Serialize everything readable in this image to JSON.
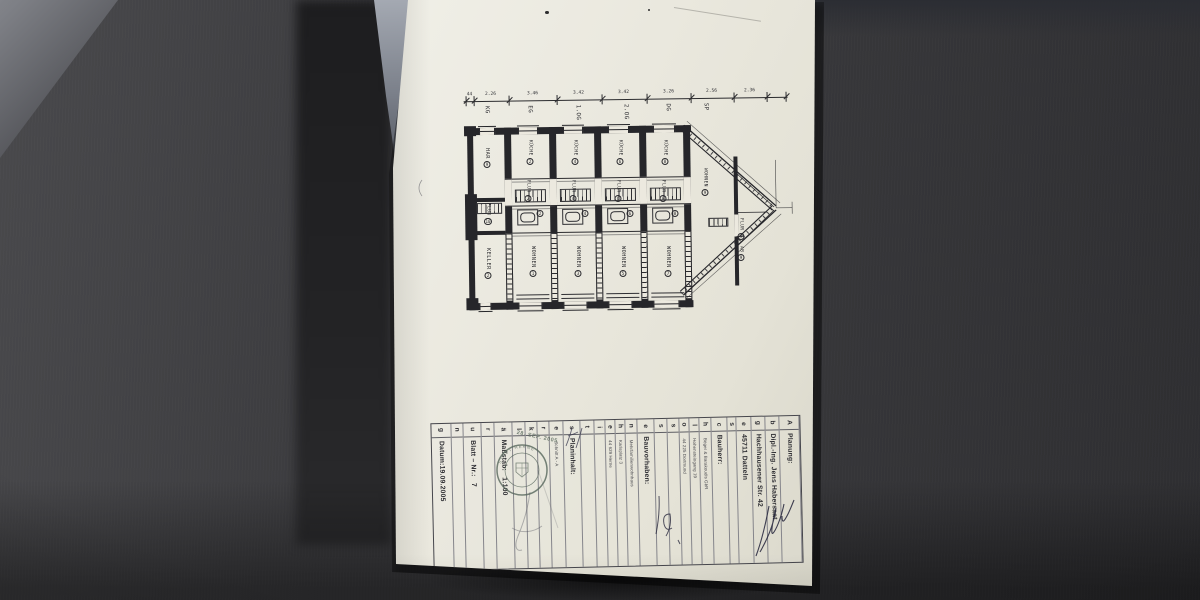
{
  "drawing": {
    "dimension": {
      "ticks": [
        {
          "css": "left:79px"
        },
        {
          "css": "left:87px"
        },
        {
          "css": "left:122px"
        },
        {
          "css": "left:170px"
        },
        {
          "css": "left:215px"
        },
        {
          "css": "left:260px"
        },
        {
          "css": "left:304px"
        },
        {
          "css": "left:347px"
        },
        {
          "css": "left:380px"
        },
        {
          "css": "left:399px"
        }
      ],
      "values": [
        {
          "v": "44",
          "css": "left:83px"
        },
        {
          "v": "2.26",
          "css": "left:104px"
        },
        {
          "v": "3.46",
          "css": "left:146px"
        },
        {
          "v": "3.42",
          "css": "left:192px"
        },
        {
          "v": "3.42",
          "css": "left:237px"
        },
        {
          "v": "3.26",
          "css": "left:282px"
        },
        {
          "v": "2.56",
          "css": "left:325px"
        },
        {
          "v": "2.36",
          "css": "left:363px"
        }
      ],
      "floors": [
        {
          "t": "KG",
          "css": "left:97px"
        },
        {
          "t": "EG",
          "css": "left:140px"
        },
        {
          "t": "1.OG",
          "css": "left:188px"
        },
        {
          "t": "2.OG",
          "css": "left:236px"
        },
        {
          "t": "DG",
          "css": "left:278px"
        },
        {
          "t": "SP",
          "css": "left:316px"
        }
      ]
    },
    "rooms": [
      {
        "t": "HAR",
        "n": "9",
        "cls": "rm",
        "css": "left:99px;top:148px"
      },
      {
        "t": "FLUR",
        "n": "10",
        "cls": "rm-sm",
        "css": "left:100px;top:203px"
      },
      {
        "t": "KELLER",
        "n": "2",
        "cls": "rm",
        "css": "left:100px;top:248px"
      },
      {
        "t": "KÜCHE",
        "n": "2",
        "cls": "rm-sm",
        "css": "left:142px;top:140px"
      },
      {
        "t": "FLUR",
        "n": "2",
        "cls": "rm-sm",
        "css": "left:140px;top:180px"
      },
      {
        "t": "",
        "n": "2",
        "cls": "circ",
        "css": "left:152px;top:210px"
      },
      {
        "t": "WOHNEN",
        "n": "1",
        "cls": "rm",
        "css": "left:145px;top:246px"
      },
      {
        "t": "KÜCHE",
        "n": "4",
        "cls": "rm-sm",
        "css": "left:187px;top:140px"
      },
      {
        "t": "FLUR",
        "n": "4",
        "cls": "rm-sm",
        "css": "left:185px;top:180px"
      },
      {
        "t": "",
        "n": "4",
        "cls": "circ",
        "css": "left:197px;top:210px"
      },
      {
        "t": "WOHNEN",
        "n": "3",
        "cls": "rm",
        "css": "left:190px;top:246px"
      },
      {
        "t": "KÜCHE",
        "n": "6",
        "cls": "rm-sm",
        "css": "left:232px;top:140px"
      },
      {
        "t": "FLUR",
        "n": "6",
        "cls": "rm-sm",
        "css": "left:230px;top:180px"
      },
      {
        "t": "",
        "n": "6",
        "cls": "circ",
        "css": "left:242px;top:210px"
      },
      {
        "t": "WOHNEN",
        "n": "5",
        "cls": "rm",
        "css": "left:235px;top:246px"
      },
      {
        "t": "KÜCHE",
        "n": "8",
        "cls": "rm-sm",
        "css": "left:277px;top:140px"
      },
      {
        "t": "FLUR",
        "n": "8",
        "cls": "rm-sm",
        "css": "left:275px;top:180px"
      },
      {
        "t": "",
        "n": "8",
        "cls": "circ",
        "css": "left:287px;top:210px"
      },
      {
        "t": "WOHNEN",
        "n": "7",
        "cls": "rm",
        "css": "left:280px;top:246px"
      },
      {
        "t": "WOHNEN",
        "n": "9",
        "cls": "rm-sm",
        "css": "left:317px;top:168px"
      },
      {
        "t": "FLUR",
        "n": "9",
        "cls": "rm-sm",
        "css": "left:353px;top:218px"
      },
      {
        "t": "AB",
        "n": "9",
        "cls": "rm-sm",
        "css": "left:353px;top:246px"
      }
    ]
  },
  "titleblock": {
    "vertical_word": "Abgeschlossenheitserklärung",
    "columns": [
      {
        "letter": "A",
        "text": "Planung:",
        "cls": "main strong",
        "css": "flex:18 0 0"
      },
      {
        "letter": "b",
        "text": "Dipl.-Ing. Jens Habersaat",
        "cls": "main",
        "css": "flex:13 0 0"
      },
      {
        "letter": "g",
        "text": "Hachhausener Str. 42",
        "cls": "main",
        "css": "flex:13 0 0"
      },
      {
        "letter": "e",
        "text": "45711 Datteln",
        "cls": "main",
        "css": "flex:13 0 0"
      },
      {
        "letter": "s",
        "text": "",
        "cls": "sm",
        "css": "flex:8 0 0"
      },
      {
        "letter": "c",
        "text": "Bauherr:",
        "cls": "main strong",
        "css": "flex:15 0 0"
      },
      {
        "letter": "h",
        "text": "Böger & Barakoudis GbR",
        "cls": "sm",
        "css": "flex:10 0 0"
      },
      {
        "letter": "l",
        "text": "Hohensteingang 19",
        "cls": "sm",
        "css": "flex:9 0 0"
      },
      {
        "letter": "o",
        "text": "44 225 Dortmund",
        "cls": "sm",
        "css": "flex:9 0 0"
      },
      {
        "letter": "s",
        "text": "",
        "cls": "sm",
        "css": "flex:10 0 0"
      },
      {
        "letter": "s",
        "text": "",
        "cls": "sm",
        "css": "flex:12 0 0"
      },
      {
        "letter": "e",
        "text": "Bauvorhaben:",
        "cls": "main strong",
        "css": "flex:16 0 0"
      },
      {
        "letter": "n",
        "text": "Mehrfamilienwohnhaus",
        "cls": "sm",
        "css": "flex:10 0 0"
      },
      {
        "letter": "h",
        "text": "Karlsplatz 3",
        "cls": "sm",
        "css": "flex:9 0 0"
      },
      {
        "letter": "e",
        "text": "44 629 Herne",
        "cls": "sm",
        "css": "flex:9 0 0"
      },
      {
        "letter": "i",
        "text": "",
        "cls": "sm",
        "css": "flex:10 0 0"
      },
      {
        "letter": "t",
        "text": "",
        "cls": "sm",
        "css": "flex:12 0 0"
      },
      {
        "letter": "s",
        "text": "Planinhalt:",
        "cls": "main strong",
        "css": "flex:16 0 0"
      },
      {
        "letter": "e",
        "text": "Schnitt A - A",
        "cls": "sm",
        "css": "flex:12 0 0"
      },
      {
        "letter": "r",
        "text": "",
        "cls": "sm",
        "css": "flex:11 0 0"
      },
      {
        "letter": "k",
        "text": "",
        "cls": "sm",
        "css": "flex:11 0 0"
      },
      {
        "letter": "l",
        "text": "",
        "cls": "sm",
        "css": "flex:11 0 0"
      },
      {
        "letter": "ä",
        "text": "Maßstab:   1:100",
        "cls": "main strong",
        "css": "flex:17 0 0"
      },
      {
        "letter": "r",
        "text": "",
        "cls": "sm",
        "css": "flex:11 0 0"
      },
      {
        "letter": "u",
        "text": "Blatt – Nr.:   7",
        "cls": "main strong",
        "css": "flex:17 0 0"
      },
      {
        "letter": "n",
        "text": "",
        "cls": "sm",
        "css": "flex:11 0 0"
      },
      {
        "letter": "g",
        "text": "Datum:19.09.2005",
        "cls": "main strong",
        "css": "flex:18 0 0"
      }
    ]
  },
  "stamps": {
    "city": "STADT HERNE",
    "date": "28. SEP. 2005"
  }
}
